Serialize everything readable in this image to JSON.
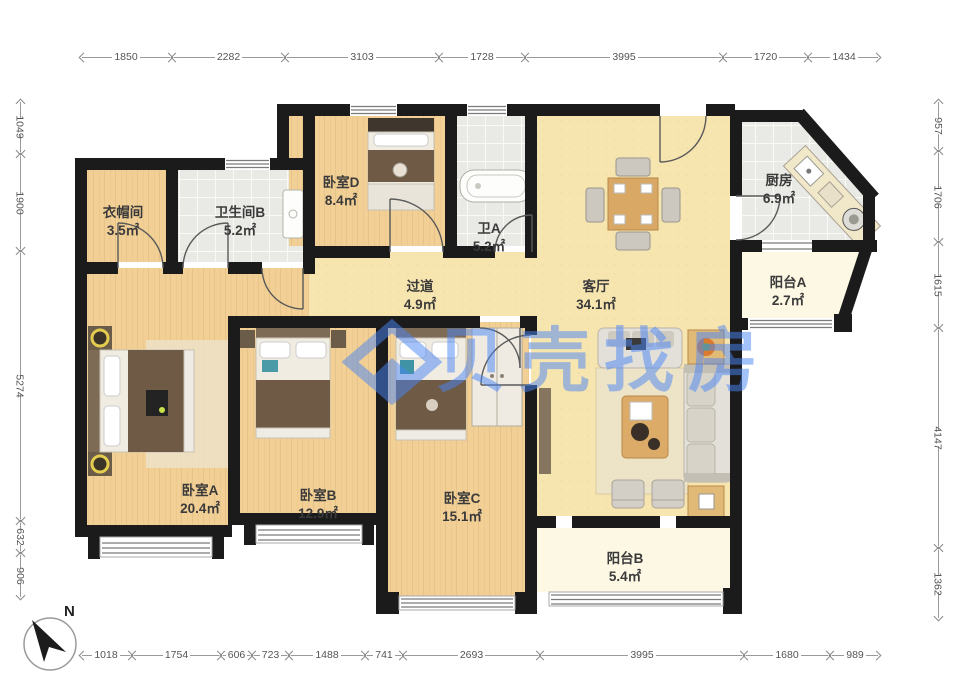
{
  "watermark": {
    "brand": "贝壳找房",
    "color": "#4a86f7"
  },
  "compass": {
    "label": "N"
  },
  "rooms": [
    {
      "id": "cloakroom",
      "name": "衣帽间",
      "area": "3.5㎡"
    },
    {
      "id": "bathroom-b",
      "name": "卫生间B",
      "area": "5.2㎡"
    },
    {
      "id": "bedroom-d",
      "name": "卧室D",
      "area": "8.4㎡"
    },
    {
      "id": "bathroom-a",
      "name": "卫A",
      "area": "5.2㎡"
    },
    {
      "id": "kitchen",
      "name": "厨房",
      "area": "6.9㎡"
    },
    {
      "id": "balcony-a",
      "name": "阳台A",
      "area": "2.7㎡"
    },
    {
      "id": "hallway",
      "name": "过道",
      "area": "4.9㎡"
    },
    {
      "id": "living-room",
      "name": "客厅",
      "area": "34.1㎡"
    },
    {
      "id": "bedroom-a",
      "name": "卧室A",
      "area": "20.4㎡"
    },
    {
      "id": "bedroom-b",
      "name": "卧室B",
      "area": "12.9㎡"
    },
    {
      "id": "bedroom-c",
      "name": "卧室C",
      "area": "15.1㎡"
    },
    {
      "id": "balcony-b",
      "name": "阳台B",
      "area": "5.4㎡"
    }
  ],
  "dimensions": {
    "top": [
      "1850",
      "2282",
      "3103",
      "1728",
      "3995",
      "1720",
      "1434"
    ],
    "bottom": [
      "1018",
      "1754",
      "606",
      "723",
      "1488",
      "741",
      "2693",
      "3995",
      "1680",
      "989"
    ],
    "left": [
      "1049",
      "1900",
      "5274",
      "632",
      "906"
    ],
    "right": [
      "957",
      "1706",
      "1615",
      "4147",
      "1362"
    ]
  }
}
